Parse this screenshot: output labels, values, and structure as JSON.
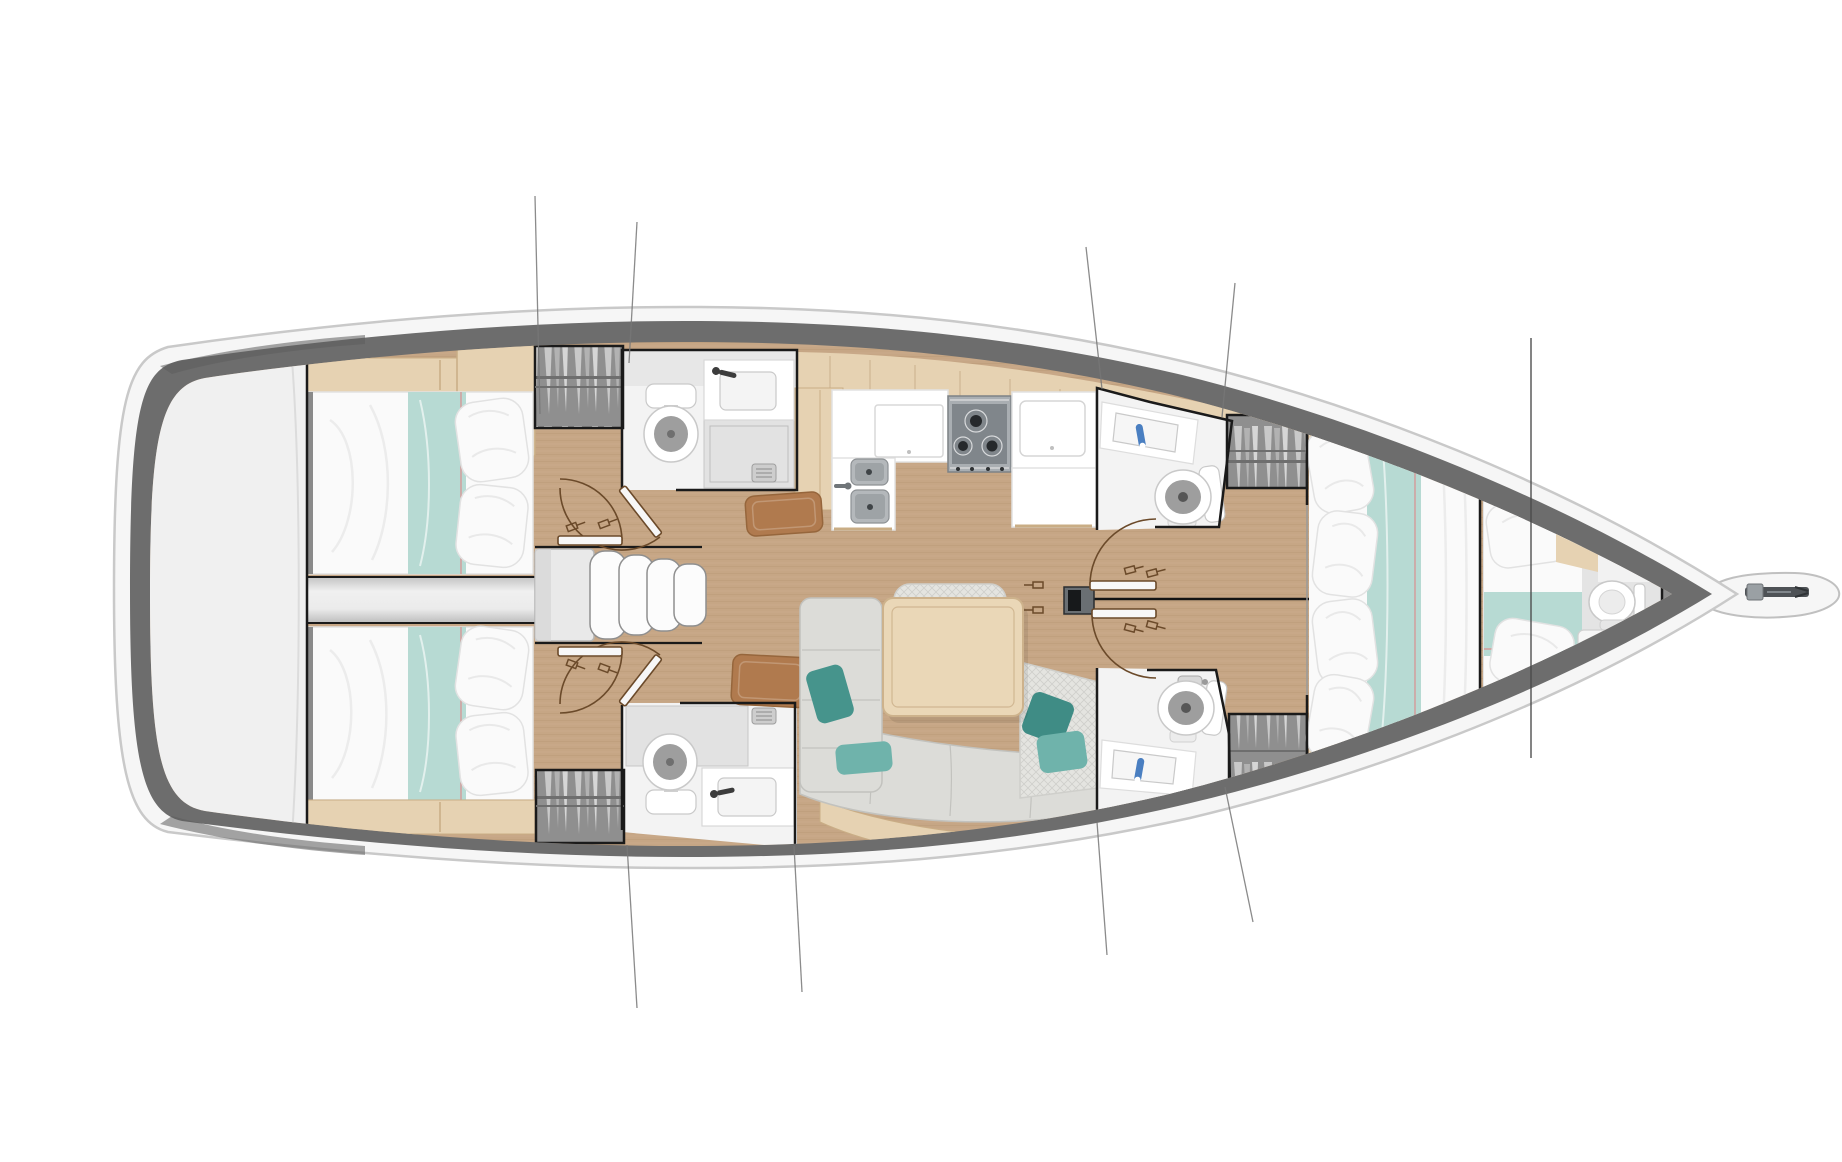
{
  "page": {
    "type": "boat-floor-plan",
    "title": "Sailboat interior layout — overhead floor plan"
  },
  "palette": {
    "bg": "#ffffff",
    "hull-stroke": "#c9c9c9",
    "hull-fill": "#f6f6f6",
    "band": "#6d6d6d",
    "band-dark": "#5d5d5d",
    "band-bow": "#8d8d8d",
    "deck": "#f0f0f0",
    "teak": "#c6a685",
    "teak-line": "#a98664",
    "wood": "#e6d2b2",
    "wood-edge": "#c9ad85",
    "table": "#ead7b7",
    "table-edge": "#cdb28c",
    "mattress": "#fafafa",
    "mattress-edge": "#e2e2e2",
    "teal": "#b7dad3",
    "teal-seam": "#d98f8f",
    "pillow-teal-dark": "#46948c",
    "pillow-teal": "#6fb3ab",
    "sofa": "#dcdcd8",
    "sofa-edge": "#c2c2be",
    "hatch-base": "#e4e4e0",
    "mat": "#b07a4e",
    "mat-edge": "#96663c",
    "bath-floor": "#f3f3f3",
    "bath-wall": "#e3e3e3",
    "shower": "#e2e2e2",
    "fixture": "#ffffff",
    "fixture-edge": "#c9c9c9",
    "bowl-inner": "#9e9e9e",
    "steel": "#b4b8bb",
    "steel-dark": "#8d9194",
    "stove": "#a9aeb2",
    "stove-dark": "#80868b",
    "burner": "#26292c",
    "wall": "#1a1a1a",
    "door": "#6b4a2a",
    "rig": "#777777",
    "stay": "#4a4a4a",
    "faucet-blue": "#4a7fc1",
    "wardrobe-bg": "#8f8f8f",
    "wardrobe-light": "#cccccc",
    "anchor": "#4e5256",
    "gray-floor": "#e4e4e4",
    "platform": "#f6f6f6",
    "platform-edge": "#c0c0c0",
    "step": "#fcfcfc",
    "step-edge": "#8f8f8f"
  },
  "plan": {
    "label": "Sailboat interior layout plan, top view",
    "hull": {
      "label": "hull with side deck band"
    },
    "regions": [
      {
        "id": "stern-deck",
        "label": "stern cockpit deck"
      },
      {
        "id": "aft-cabin-port",
        "label": "aft double cabin, port side",
        "features": [
          "double-berth",
          "teal-runner",
          "pillows",
          "shelf"
        ]
      },
      {
        "id": "aft-cabin-starboard",
        "label": "aft double cabin, starboard side",
        "features": [
          "double-berth",
          "teal-runner",
          "pillows",
          "shelf"
        ]
      },
      {
        "id": "engine-compartment",
        "label": "engine compartment between aft cabins"
      },
      {
        "id": "companionway",
        "label": "companionway entry steps",
        "features": [
          "landing-platform",
          "four-curved-treads"
        ]
      },
      {
        "id": "head-aft-port",
        "label": "aft head with shower, port",
        "features": [
          "toilet",
          "sink",
          "shower-pan"
        ]
      },
      {
        "id": "head-aft-starboard",
        "label": "aft head with shower, starboard",
        "features": [
          "toilet",
          "sink",
          "shower-pan"
        ]
      },
      {
        "id": "galley",
        "label": "galley",
        "features": [
          "double-stainless-sink",
          "three-burner-stove",
          "refrigerator-counter",
          "side-lockers"
        ]
      },
      {
        "id": "salon",
        "label": "salon seating area",
        "features": [
          "l-shaped-settee",
          "dining-table",
          "teal-cushions",
          "backrest-cushion",
          "leather-mats"
        ]
      },
      {
        "id": "mast",
        "label": "mast base on centerline"
      },
      {
        "id": "head-forward-port",
        "label": "forward head, port",
        "features": [
          "toilet",
          "sink"
        ]
      },
      {
        "id": "head-forward-starboard",
        "label": "forward head, starboard",
        "features": [
          "toilet",
          "sink"
        ]
      },
      {
        "id": "wardrobes",
        "label": "four hanging lockers"
      },
      {
        "id": "forward-cabin",
        "label": "forward owner cabin",
        "features": [
          "island-berth",
          "pillows",
          "teal-runner"
        ]
      },
      {
        "id": "bow-cabin",
        "label": "bow crew cabin",
        "features": [
          "single-berth",
          "toilet",
          "round-sink"
        ]
      },
      {
        "id": "bowsprit",
        "label": "bowsprit with anchor roller"
      }
    ],
    "rigging": {
      "label": "standing rigging shroud lines",
      "count": 8,
      "forestay": "forestay line at bow"
    }
  }
}
